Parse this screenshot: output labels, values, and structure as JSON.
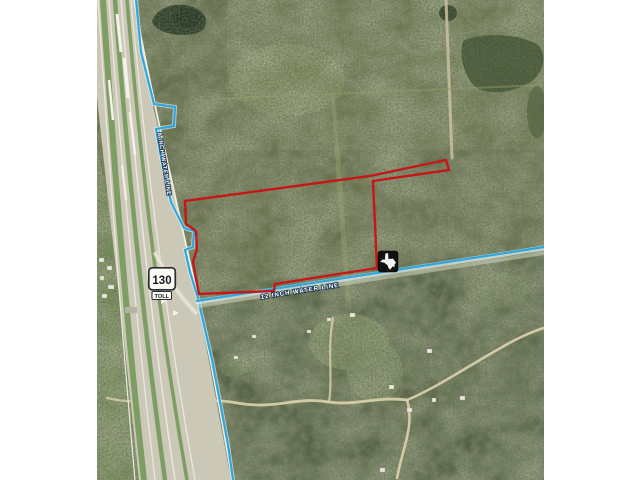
{
  "window": {
    "background": "#ffffff",
    "kind": "aerial parcel exhibit image"
  },
  "map": {
    "labels": {
      "water_line_8": "8 INCH WATER LINE",
      "water_line_12": "12 INCH WATER LINE"
    },
    "highway_shield": {
      "route_number": "130",
      "banner": "TOLL"
    },
    "icons": [
      "route-shield-130-toll",
      "texas-logo-icon"
    ],
    "colors": {
      "parcel_boundary": "#c81616",
      "water_line": "#2fa6dc",
      "water_line_casing": "#e6f3f8",
      "label_text": "#ffffff",
      "label_halo": "#14324f",
      "terrain_base": "#5f6b45",
      "forest_dark": "#4d5c3b",
      "pavement": "#cbc8b7",
      "dirt_road": "#d8cdaa",
      "shield_face": "#fbfbf6",
      "shield_border": "#2a2a33",
      "logo_background": "#111111"
    }
  }
}
